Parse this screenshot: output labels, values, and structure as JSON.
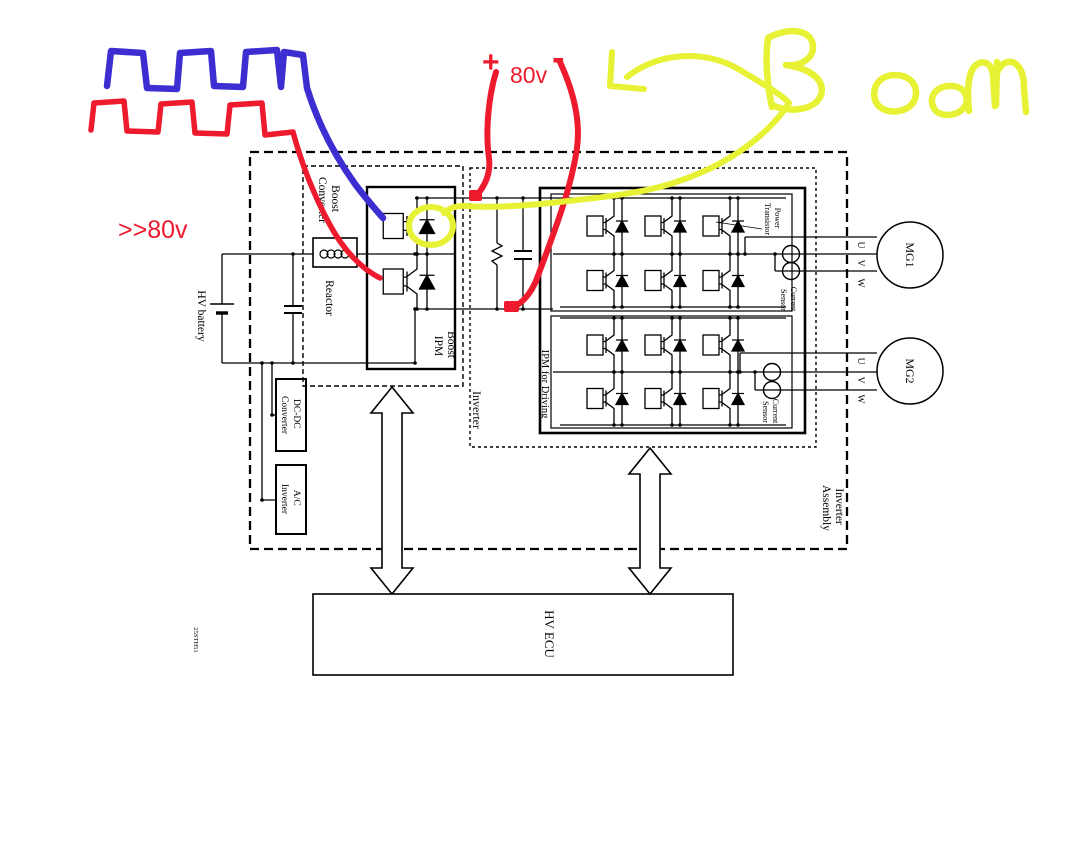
{
  "colors": {
    "line_black": "#000000",
    "annotation_red": "#ee1b2e",
    "annotation_blue": "#3c2ed0",
    "annotation_yellow": "#e6f233"
  },
  "labels": {
    "hv_battery": "HV battery",
    "reactor": "Reactor",
    "boost_converter": {
      "line1": "Boost",
      "line2": "Converter"
    },
    "boost_ipm": {
      "line1": "Boost",
      "line2": "IPM"
    },
    "dc_dc_converter": {
      "line1": "DC-DC",
      "line2": "Converter"
    },
    "ac_inverter": {
      "line1": "A/C",
      "line2": "Inverter"
    },
    "inverter": "Inverter",
    "inverter_assembly": {
      "line1": "Inverter",
      "line2": "Assembly"
    },
    "ipm_for_driving": "IPM for Driving",
    "power_transistor": {
      "line1": "Power",
      "line2": "Transistor"
    },
    "current_sensor": {
      "line1": "Current",
      "line2": "Sensor"
    },
    "phase_u": "U",
    "phase_v": "V",
    "phase_w": "W",
    "mg1": "MG1",
    "mg2": "MG2",
    "hv_ecu": "HV ECU",
    "part_code": "25STH51"
  },
  "annotations": {
    "plus": "+",
    "voltage": "80v",
    "minus": "-",
    "over_voltage": ">>80v",
    "boom": "Boom"
  }
}
